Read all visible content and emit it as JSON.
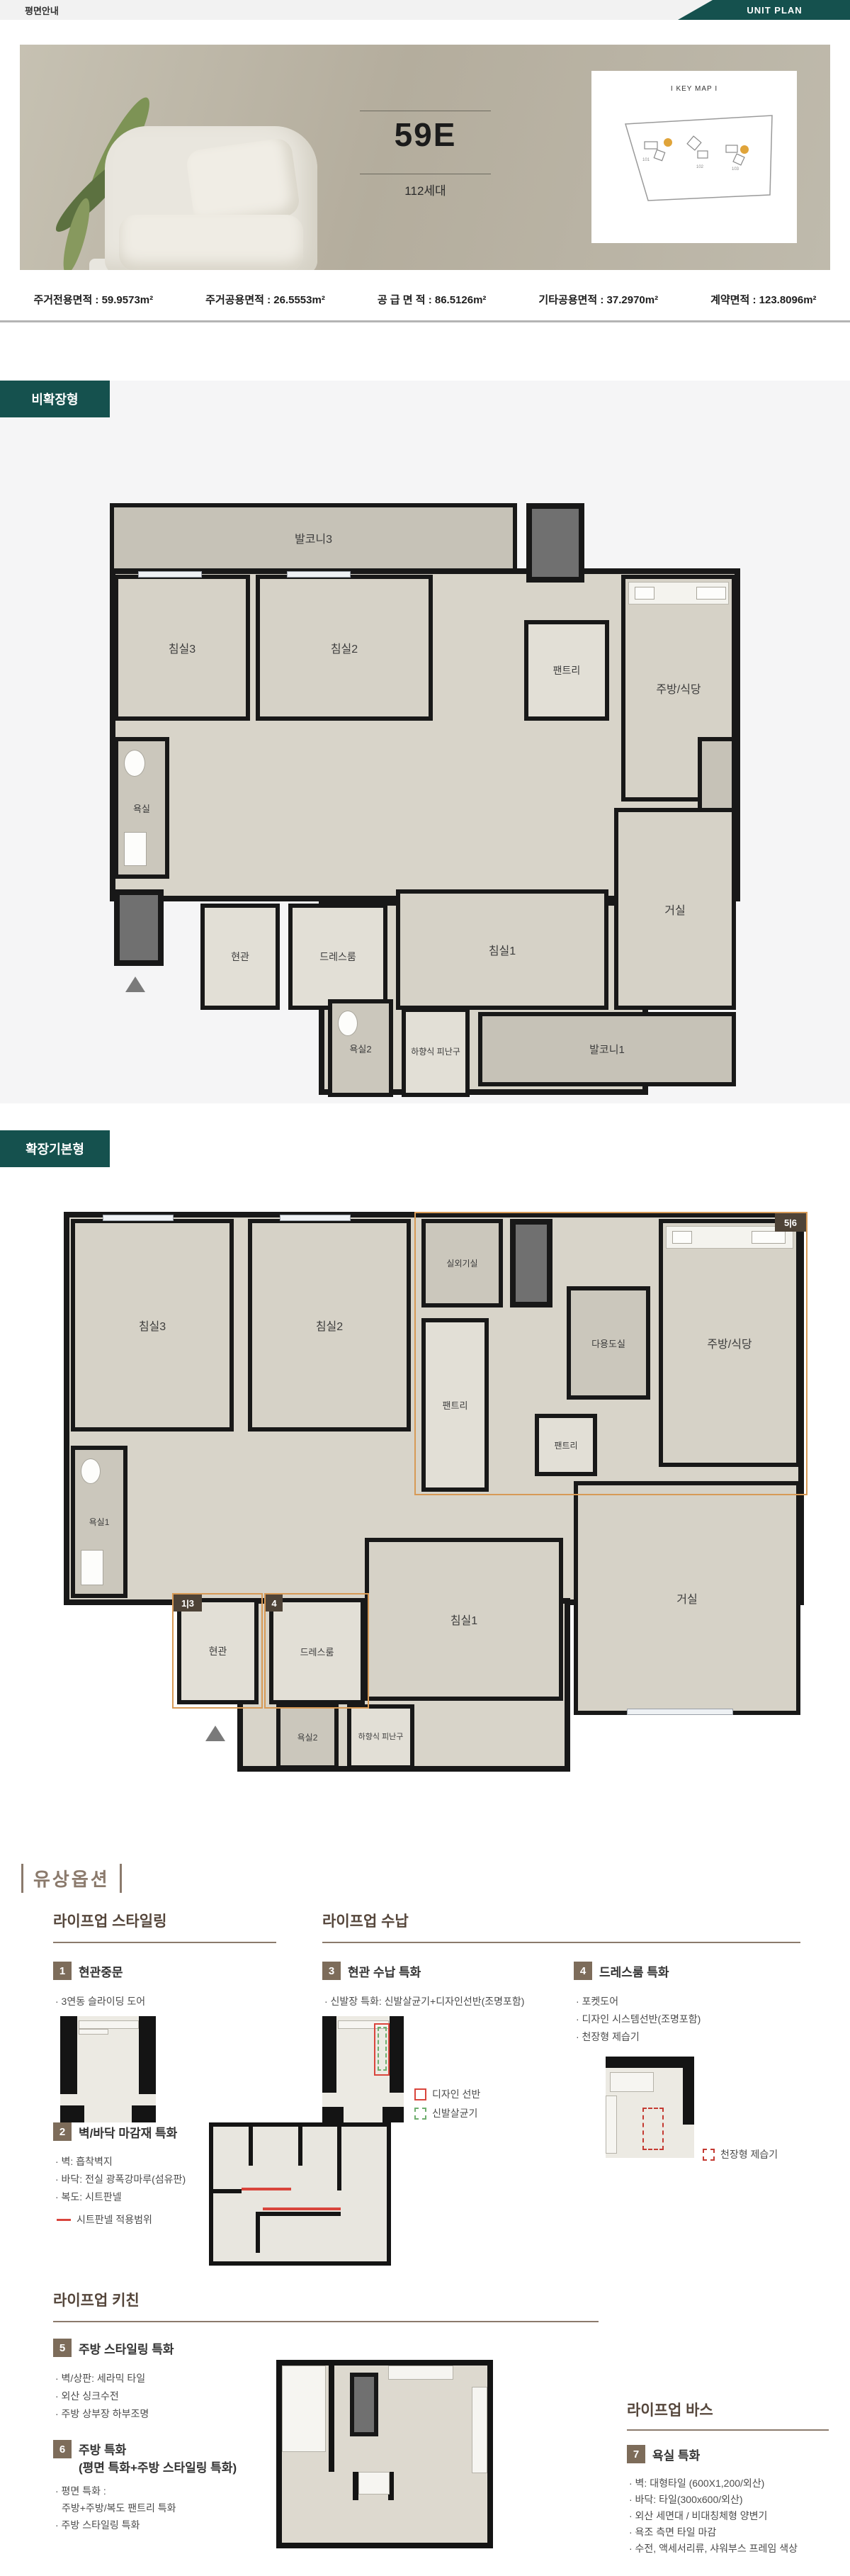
{
  "header": {
    "title": "평면안내",
    "ribbon_label": "UNIT PLAN"
  },
  "hero": {
    "unit_name": "59E",
    "households": "112세대",
    "keymap_title": "I KEY MAP I"
  },
  "area_info": {
    "items": [
      "주거전용면적 : 59.9573m²",
      "주거공용면적 : 26.5553m²",
      "공 급 면 적 : 86.5126m²",
      "기타공용면적 : 37.2970m²",
      "계약면적 : 123.8096m²"
    ]
  },
  "plan_nonexpanded": {
    "badge": "비확장형",
    "rooms": {
      "balcony3": "발코니3",
      "bed3": "침실3",
      "bed2": "침실2",
      "pantry": "팬트리",
      "kitchen": "주방/식당",
      "bath": "욕실",
      "entry": "현관",
      "dressroom": "드레스룸",
      "bed1": "침실1",
      "living": "거실",
      "balcony2": "발코니2",
      "balcony1": "발코니1",
      "bath2": "욕실2",
      "escape": "하향식 피난구"
    }
  },
  "plan_expanded": {
    "badge": "확장기본형",
    "rooms": {
      "bed3": "침실3",
      "bed2": "침실2",
      "outdoor_unit": "실외기실",
      "pantry1": "팬트리",
      "utility": "다용도실",
      "kitchen": "주방/식당",
      "pantry2": "팬트리",
      "bath1": "욕실1",
      "entry": "현관",
      "dressroom": "드레스룸",
      "bed1": "침실1",
      "living": "거실",
      "bath2": "욕실2",
      "escape": "하향식 피난구"
    },
    "markers": {
      "kitchen_zone": "5|6",
      "entry_zone": "1|3",
      "dress_zone": "4"
    }
  },
  "options": {
    "title": "유상옵션",
    "styling": {
      "header": "라이프업 스타일링",
      "item1": {
        "no": "1",
        "title": "현관중문",
        "bullets": [
          "· 3연동 슬라이딩 도어"
        ]
      },
      "item2": {
        "no": "2",
        "title": "벽/바닥 마감재 특화",
        "bullets": [
          "· 벽: 흡착벽지",
          "· 바닥: 전실 광폭강마루(섬유판)",
          "· 복도: 시트판넬"
        ],
        "legend": "시트판넬 적용범위"
      }
    },
    "storage": {
      "header": "라이프업 수납",
      "item3": {
        "no": "3",
        "title": "현관 수납 특화",
        "bullets": [
          "· 신발장 특화: 신발살균기+디자인선반(조명포함)"
        ],
        "legend_shelf": "디자인 선반",
        "legend_sterilizer": "신발살균기"
      },
      "item4": {
        "no": "4",
        "title": "드레스룸 특화",
        "bullets": [
          "· 포켓도어",
          "· 디자인 시스템선반(조명포함)",
          "· 천장형 제습기"
        ],
        "legend_dehumidifier": "천장형 제습기"
      }
    },
    "kitchen": {
      "header": "라이프업 키친",
      "item5": {
        "no": "5",
        "title": "주방 스타일링 특화",
        "bullets": [
          "· 벽/상판: 세라믹 타일",
          "· 외산 싱크수전",
          "· 주방 상부장 하부조명"
        ]
      },
      "item6": {
        "no": "6",
        "title": "주방 특화",
        "subtitle": "(평면 특화+주방 스타일링 특화)",
        "bullets": [
          "· 평면 특화 :",
          "주방+주방/복도 팬트리 특화",
          "· 주방 스타일링 특화"
        ]
      }
    },
    "bath": {
      "header": "라이프업 바스",
      "item7": {
        "no": "7",
        "title": "욕실 특화",
        "bullets": [
          "· 벽: 대형타일 (600X1,200/외산)",
          "· 바닥: 타일(300x600/외산)",
          "· 외산 세면대 / 비대칭체형 양변기",
          "· 욕조 측면 타일 마감",
          "· 수전, 액세서리류, 샤워부스 프레임 색상"
        ]
      }
    }
  },
  "colors": {
    "teal": "#15514e",
    "accent_orange": "#d79a56",
    "badge_brown": "#7d6c5a",
    "marker_brown": "#4e4337",
    "highlight_red": "#d9453c",
    "dash_green": "#6fae6f"
  }
}
